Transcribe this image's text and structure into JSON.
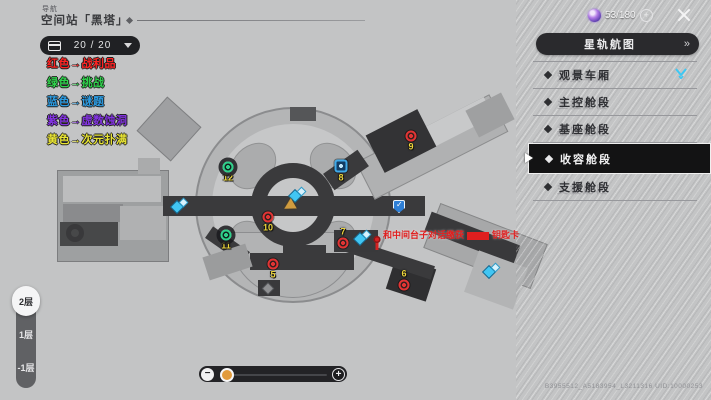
{
  "header": {
    "nav_label": "导航",
    "title": "空间站「黑塔」"
  },
  "topbar": {
    "currency_count": "53/180",
    "plus_label": "+"
  },
  "chest_badge": {
    "count": "20 / 20"
  },
  "legend": {
    "items": [
      {
        "text": "红色→战利品",
        "color": "#ff2323"
      },
      {
        "text": "绿色→挑战",
        "color": "#2ed24b"
      },
      {
        "text": "蓝色→谜题",
        "color": "#2b9be2"
      },
      {
        "text": "紫色→虚数蚀洞",
        "color": "#8233e0"
      },
      {
        "text": "黄色→次元扑满",
        "color": "#e8e433"
      }
    ]
  },
  "sidebar": {
    "header": "星轨航图",
    "chevrons": "»",
    "items": [
      {
        "label": "观景车厢",
        "tracked": true
      },
      {
        "label": "主控舱段"
      },
      {
        "label": "基座舱段"
      },
      {
        "label": "收容舱段",
        "selected": true,
        "cursor": true
      },
      {
        "label": "支援舱段"
      }
    ]
  },
  "map": {
    "annotation": {
      "before": "和中间台子对话缴获",
      "after": "钥匙卡"
    },
    "markers": [
      {
        "type": "green",
        "num": "12",
        "x": 228,
        "y": 172
      },
      {
        "type": "green",
        "num": "11",
        "x": 226,
        "y": 240
      },
      {
        "type": "red",
        "num": "10",
        "x": 268,
        "y": 222
      },
      {
        "type": "red",
        "num": "5",
        "x": 273,
        "y": 269
      },
      {
        "type": "red",
        "num": "9",
        "x": 411,
        "y": 141
      },
      {
        "type": "blue-box",
        "num": "8",
        "x": 341,
        "y": 171
      },
      {
        "type": "red",
        "num": "7",
        "x": 343,
        "y": 238,
        "np": "above"
      },
      {
        "type": "red",
        "num": "6",
        "x": 404,
        "y": 280,
        "np": "above"
      },
      {
        "type": "spark",
        "x": 180,
        "y": 207
      },
      {
        "type": "spark",
        "x": 298,
        "y": 196
      },
      {
        "type": "spark",
        "x": 363,
        "y": 239
      },
      {
        "type": "spark",
        "x": 492,
        "y": 272
      },
      {
        "type": "shield",
        "x": 399,
        "y": 207
      },
      {
        "type": "star",
        "x": 268,
        "y": 289
      }
    ]
  },
  "floors": {
    "items": [
      {
        "label": "2层",
        "selected": true
      },
      {
        "label": "1层"
      },
      {
        "label": "-1层"
      }
    ]
  },
  "zoom_slider": {
    "minus": "−",
    "plus": "+",
    "value_percent": 14
  },
  "watermark": "B3955512_A5183954_L3211316  UID:10000253",
  "colors": {
    "accent_cyan": "#3cc8f4",
    "marker_yellow": "#ecd53c",
    "annotation_red": "#e01f1f",
    "selected_bg": "#131314"
  }
}
